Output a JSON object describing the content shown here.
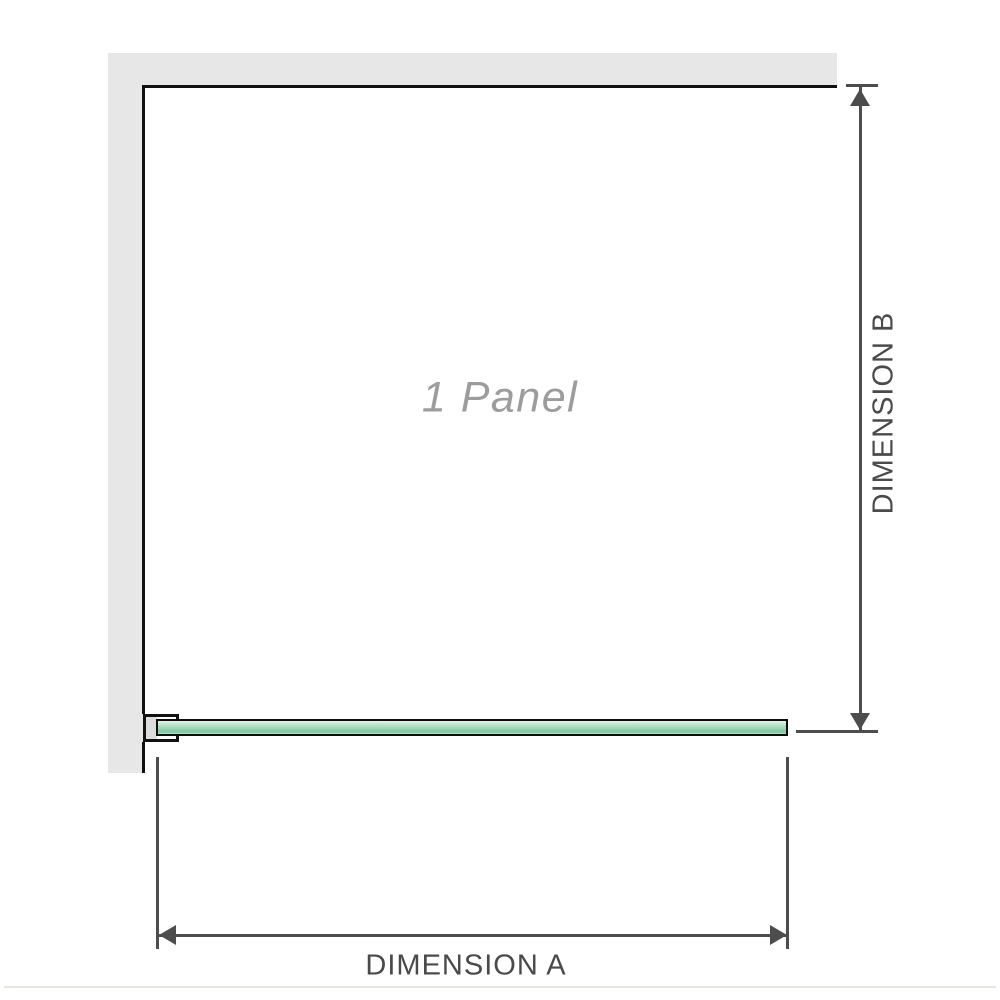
{
  "diagram": {
    "panel_label": "1 Panel",
    "dimension_a_label": "DIMENSION A",
    "dimension_b_label": "DIMENSION B"
  },
  "colors": {
    "background": "#ffffff",
    "wall": "#e7e7e7",
    "frame": "#111111",
    "glass-border": "#0d0d0d",
    "glass-light": "#e3f4ea",
    "glass-soft": "#bfe6cc",
    "glass-mid": "#9ed8b6",
    "glass-dark": "#7fc29b",
    "dim-line": "#4d4d4d",
    "dim-text": "#4a4a4a",
    "panel-text": "#9c9c9c",
    "baseline": "#e9e5df"
  }
}
